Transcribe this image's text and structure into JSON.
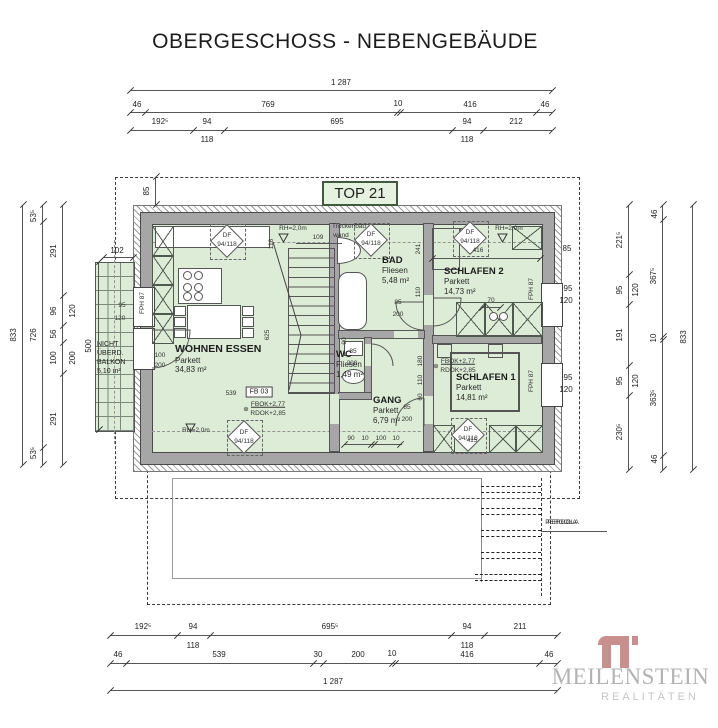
{
  "title": "OBERGESCHOSS - NEBENGEBÄUDE",
  "top_label": "TOP 21",
  "pergola_label": "PERGOLA",
  "logo": {
    "name": "MEILENSTEIN",
    "subtitle": "REALITÄTEN"
  },
  "colors": {
    "room_fill": "#dcecd6",
    "wall_gray": "#a6a6a6",
    "line": "#4a4a4a",
    "top_box_bg": "#e6f2e0",
    "top_box_border": "#3f5a3c",
    "logo_accent": "#c98f8f",
    "logo_gray": "#b3b3b3"
  },
  "rooms": [
    {
      "name": "WOHNEN ESSEN",
      "finish": "Parkett",
      "area": "34,83 m²"
    },
    {
      "name": "BAD",
      "finish": "Fliesen",
      "area": "5,48 m²"
    },
    {
      "name": "SCHLAFEN 2",
      "finish": "Parkett",
      "area": "14,73 m²"
    },
    {
      "name": "WC",
      "finish": "Fliesen",
      "area": "1,49 m²"
    },
    {
      "name": "GANG",
      "finish": "Parkett",
      "area": "6,79 m²"
    },
    {
      "name": "SCHLAFEN 1",
      "finish": "Parkett",
      "area": "14,81 m²"
    }
  ],
  "balcony": {
    "l1": "NICHT",
    "l2": "ÜBERD.",
    "l3": "BALKON",
    "area": "5,10 m²"
  },
  "annotations": {
    "lines": [
      {
        "o": "h",
        "x": 130,
        "y": 90,
        "l": 422,
        "k": [
          0,
          422
        ]
      },
      {
        "o": "h",
        "x": 130,
        "y": 112,
        "l": 422,
        "k": [
          0,
          15,
          267,
          270,
          406,
          422
        ]
      },
      {
        "o": "h",
        "x": 130,
        "y": 130,
        "l": 422,
        "k": [
          0,
          63,
          94,
          322,
          353,
          422
        ]
      },
      {
        "o": "h",
        "x": 110,
        "y": 635,
        "l": 447,
        "k": [
          0,
          67,
          100,
          341,
          374,
          447
        ]
      },
      {
        "o": "h",
        "x": 110,
        "y": 663,
        "l": 447,
        "k": [
          0,
          16,
          203,
          213,
          282,
          285,
          429,
          447
        ]
      },
      {
        "o": "h",
        "x": 110,
        "y": 690,
        "l": 447,
        "k": [
          0,
          447
        ]
      },
      {
        "o": "h",
        "x": 103,
        "y": 257,
        "l": 30,
        "k": [
          0,
          30
        ]
      },
      {
        "o": "h",
        "x": 432,
        "y": 258,
        "l": 108,
        "k": [
          0,
          108
        ]
      },
      {
        "o": "h",
        "x": 344,
        "y": 444,
        "l": 58,
        "k": [
          0,
          27,
          30,
          56
        ]
      },
      {
        "o": "h",
        "x": 482,
        "y": 307,
        "l": 18,
        "k": [
          0,
          18
        ]
      },
      {
        "o": "h",
        "x": 296,
        "y": 243,
        "l": 46,
        "k": []
      },
      {
        "o": "h",
        "x": 541,
        "y": 531,
        "l": 66,
        "k": []
      },
      {
        "o": "v",
        "x": 22,
        "y": 205,
        "l": 260,
        "k": [
          0,
          260
        ]
      },
      {
        "o": "v",
        "x": 42,
        "y": 205,
        "l": 260,
        "k": [
          0,
          17,
          243,
          260
        ]
      },
      {
        "o": "v",
        "x": 62,
        "y": 205,
        "l": 260,
        "k": [
          0,
          91,
          121,
          138,
          169,
          260
        ]
      },
      {
        "o": "v",
        "x": 98,
        "y": 262,
        "l": 168,
        "k": [
          0,
          168
        ]
      },
      {
        "o": "v",
        "x": 155,
        "y": 177,
        "l": 28,
        "k": [
          0,
          28
        ]
      },
      {
        "o": "v",
        "x": 628,
        "y": 205,
        "l": 265,
        "k": [
          0,
          70,
          100,
          161,
          191,
          265
        ]
      },
      {
        "o": "v",
        "x": 662,
        "y": 205,
        "l": 265,
        "k": [
          0,
          15,
          132,
          135,
          251,
          265
        ]
      },
      {
        "o": "v",
        "x": 692,
        "y": 205,
        "l": 265,
        "k": [
          0,
          265
        ]
      }
    ],
    "labels": [
      {
        "t": "1 287",
        "x": 341,
        "y": 83
      },
      {
        "t": "46",
        "x": 137,
        "y": 105
      },
      {
        "t": "769",
        "x": 268,
        "y": 105
      },
      {
        "t": "10",
        "x": 398,
        "y": 104
      },
      {
        "t": "416",
        "x": 470,
        "y": 105
      },
      {
        "t": "46",
        "x": 545,
        "y": 105
      },
      {
        "t": "192⁵",
        "x": 160,
        "y": 122
      },
      {
        "t": "94",
        "x": 207,
        "y": 122
      },
      {
        "t": "695",
        "x": 337,
        "y": 122
      },
      {
        "t": "94",
        "x": 467,
        "y": 122
      },
      {
        "t": "212",
        "x": 516,
        "y": 122
      },
      {
        "t": "118",
        "x": 207,
        "y": 140
      },
      {
        "t": "118",
        "x": 467,
        "y": 140
      },
      {
        "t": "192⁵",
        "x": 143,
        "y": 627
      },
      {
        "t": "94",
        "x": 193,
        "y": 627
      },
      {
        "t": "695⁵",
        "x": 330,
        "y": 627
      },
      {
        "t": "94",
        "x": 467,
        "y": 627
      },
      {
        "t": "211",
        "x": 520,
        "y": 627
      },
      {
        "t": "118",
        "x": 193,
        "y": 646
      },
      {
        "t": "118",
        "x": 467,
        "y": 646
      },
      {
        "t": "46",
        "x": 118,
        "y": 655
      },
      {
        "t": "539",
        "x": 219,
        "y": 655
      },
      {
        "t": "30",
        "x": 318,
        "y": 655
      },
      {
        "t": "200",
        "x": 358,
        "y": 655
      },
      {
        "t": "10",
        "x": 392,
        "y": 654
      },
      {
        "t": "416",
        "x": 467,
        "y": 655
      },
      {
        "t": "46",
        "x": 549,
        "y": 655
      },
      {
        "t": "1 287",
        "x": 333,
        "y": 682
      },
      {
        "t": "833",
        "x": 14,
        "y": 335,
        "r": 1
      },
      {
        "t": "53⁵",
        "x": 34,
        "y": 216,
        "r": 1
      },
      {
        "t": "726",
        "x": 34,
        "y": 335,
        "r": 1
      },
      {
        "t": "53⁵",
        "x": 34,
        "y": 453,
        "r": 1
      },
      {
        "t": "291",
        "x": 54,
        "y": 251,
        "r": 1
      },
      {
        "t": "96",
        "x": 54,
        "y": 311,
        "r": 1
      },
      {
        "t": "56",
        "x": 54,
        "y": 334,
        "r": 1
      },
      {
        "t": "100",
        "x": 54,
        "y": 358,
        "r": 1
      },
      {
        "t": "291",
        "x": 54,
        "y": 419,
        "r": 1
      },
      {
        "t": "120",
        "x": 73,
        "y": 311,
        "r": 1
      },
      {
        "t": "200",
        "x": 73,
        "y": 358,
        "r": 1
      },
      {
        "t": "500",
        "x": 89,
        "y": 346,
        "r": 1
      },
      {
        "t": "102",
        "x": 117,
        "y": 251
      },
      {
        "t": "85",
        "x": 147,
        "y": 191,
        "r": 1
      },
      {
        "t": "221⁵",
        "x": 620,
        "y": 240,
        "r": 1
      },
      {
        "t": "95",
        "x": 620,
        "y": 290,
        "r": 1
      },
      {
        "t": "120",
        "x": 636,
        "y": 290,
        "r": 1
      },
      {
        "t": "191",
        "x": 620,
        "y": 335,
        "r": 1
      },
      {
        "t": "95",
        "x": 620,
        "y": 381,
        "r": 1
      },
      {
        "t": "120",
        "x": 636,
        "y": 381,
        "r": 1
      },
      {
        "t": "230⁵",
        "x": 620,
        "y": 432,
        "r": 1
      },
      {
        "t": "46",
        "x": 655,
        "y": 214,
        "r": 1
      },
      {
        "t": "367⁵",
        "x": 654,
        "y": 276,
        "r": 1
      },
      {
        "t": "10",
        "x": 654,
        "y": 338,
        "r": 1
      },
      {
        "t": "363⁵",
        "x": 654,
        "y": 398,
        "r": 1
      },
      {
        "t": "46",
        "x": 655,
        "y": 459,
        "r": 1
      },
      {
        "t": "833",
        "x": 684,
        "y": 337,
        "r": 1
      },
      {
        "t": "85",
        "x": 567,
        "y": 249
      },
      {
        "t": "95",
        "x": 568,
        "y": 289
      },
      {
        "t": "120",
        "x": 566,
        "y": 301
      },
      {
        "t": "95",
        "x": 568,
        "y": 378
      },
      {
        "t": "120",
        "x": 566,
        "y": 390
      },
      {
        "t": "109",
        "x": 318,
        "y": 238,
        "s": 1
      },
      {
        "t": "116",
        "x": 272,
        "y": 244,
        "r": 1,
        "s": 1
      },
      {
        "t": "625",
        "x": 268,
        "y": 335,
        "r": 1,
        "s": 1
      },
      {
        "t": "539",
        "x": 231,
        "y": 394,
        "s": 1
      },
      {
        "t": "416",
        "x": 478,
        "y": 251,
        "s": 1
      },
      {
        "t": "70",
        "x": 491,
        "y": 301,
        "s": 1
      },
      {
        "t": "100",
        "x": 160,
        "y": 356,
        "s": 1
      },
      {
        "t": "200",
        "x": 160,
        "y": 366,
        "s": 1
      },
      {
        "t": "85",
        "x": 398,
        "y": 303,
        "s": 1
      },
      {
        "t": "200",
        "x": 398,
        "y": 315,
        "s": 1
      },
      {
        "t": "85",
        "x": 353,
        "y": 352,
        "s": 1
      },
      {
        "t": "200",
        "x": 352,
        "y": 364,
        "s": 1
      },
      {
        "t": "85",
        "x": 407,
        "y": 408,
        "s": 1
      },
      {
        "t": "200",
        "x": 407,
        "y": 420,
        "s": 1
      },
      {
        "t": "95",
        "x": 122,
        "y": 306,
        "s": 1
      },
      {
        "t": "120",
        "x": 120,
        "y": 319,
        "s": 1
      },
      {
        "t": "90",
        "x": 345,
        "y": 341,
        "r": 1,
        "s": 1
      },
      {
        "t": "90",
        "x": 351,
        "y": 439,
        "s": 1
      },
      {
        "t": "10",
        "x": 365,
        "y": 439,
        "s": 1
      },
      {
        "t": "100",
        "x": 381,
        "y": 439,
        "s": 1
      },
      {
        "t": "10",
        "x": 396,
        "y": 439,
        "s": 1
      },
      {
        "t": "180",
        "x": 421,
        "y": 361,
        "r": 1,
        "s": 1
      },
      {
        "t": "110",
        "x": 421,
        "y": 380,
        "r": 1,
        "s": 1
      },
      {
        "t": "60",
        "x": 421,
        "y": 397,
        "r": 1,
        "s": 1
      },
      {
        "t": "241",
        "x": 419,
        "y": 249,
        "r": 1,
        "s": 1
      },
      {
        "t": "110",
        "x": 419,
        "y": 292,
        "r": 1,
        "s": 1
      },
      {
        "t": "415",
        "x": 472,
        "y": 441,
        "s": 1
      },
      {
        "t": "RH=2,0m",
        "x": 293,
        "y": 229,
        "s": 1
      },
      {
        "t": "RH=2,0m",
        "x": 509,
        "y": 229,
        "s": 1
      },
      {
        "t": "RH=2,0m",
        "x": 196,
        "y": 431,
        "s": 1
      },
      {
        "t": "Trockenbau",
        "x": 349,
        "y": 227,
        "s": 1
      },
      {
        "t": "wand",
        "x": 341,
        "y": 236,
        "s": 1
      },
      {
        "t": "DF",
        "x": 227,
        "y": 236,
        "s": 1
      },
      {
        "t": "94/118",
        "x": 227,
        "y": 245,
        "s": 1
      },
      {
        "t": "DF",
        "x": 371,
        "y": 235,
        "s": 1
      },
      {
        "t": "94/118",
        "x": 371,
        "y": 244,
        "s": 1
      },
      {
        "t": "DF",
        "x": 470,
        "y": 233,
        "s": 1
      },
      {
        "t": "94/118",
        "x": 470,
        "y": 242,
        "s": 1
      },
      {
        "t": "DF",
        "x": 244,
        "y": 433,
        "s": 1
      },
      {
        "t": "94/118",
        "x": 244,
        "y": 442,
        "s": 1
      },
      {
        "t": "DF",
        "x": 468,
        "y": 430,
        "s": 1
      },
      {
        "t": "94/118",
        "x": 468,
        "y": 439,
        "s": 1
      },
      {
        "t": "⊕",
        "x": 246,
        "y": 410,
        "s": 1
      },
      {
        "t": "FBOK+2,77",
        "x": 268,
        "y": 405,
        "s": 1,
        "u": 1
      },
      {
        "t": "RDOK+2,85",
        "x": 268,
        "y": 414,
        "s": 1
      },
      {
        "t": "⊕",
        "x": 436,
        "y": 367,
        "s": 1
      },
      {
        "t": "FBOK+2,77",
        "x": 458,
        "y": 362,
        "s": 1,
        "u": 1
      },
      {
        "t": "RDOK+2,85",
        "x": 458,
        "y": 371,
        "s": 1
      },
      {
        "t": "FB 03",
        "x": 259,
        "y": 392,
        "b": 1
      },
      {
        "t": "FPH 87",
        "x": 143,
        "y": 303,
        "r": 1,
        "s": 1
      },
      {
        "t": "FPH 87",
        "x": 532,
        "y": 289,
        "r": 1,
        "s": 1
      },
      {
        "t": "FPH 87",
        "x": 532,
        "y": 381,
        "r": 1,
        "s": 1
      },
      {
        "t": "PERGOLA",
        "x": 561,
        "y": 523,
        "s": 1
      }
    ]
  }
}
